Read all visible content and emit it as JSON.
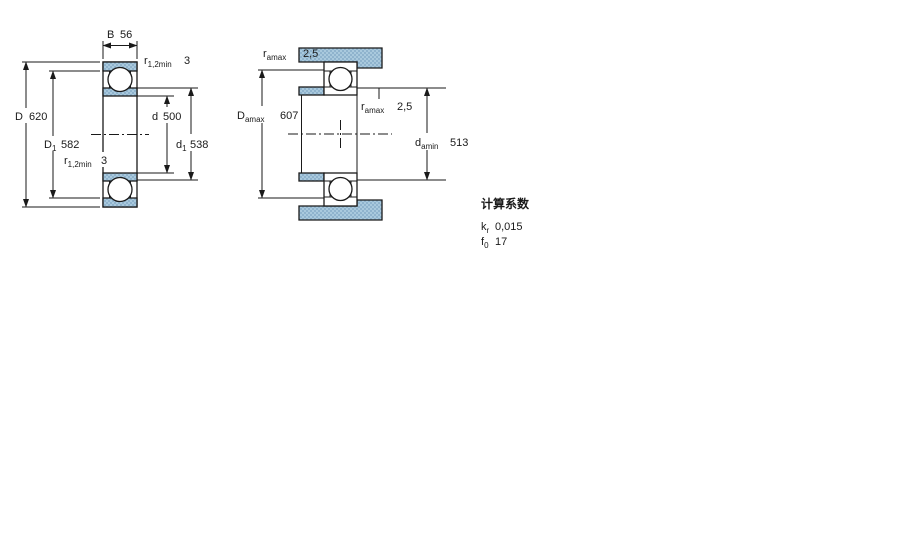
{
  "drawing": {
    "left": {
      "B": {
        "sym": "B",
        "value": "56"
      },
      "r_top": {
        "sym": "r",
        "sub": "1,2min",
        "value": "3"
      },
      "D": {
        "sym": "D",
        "value": "620"
      },
      "D1": {
        "sym": "D",
        "sub": "1",
        "value": "582"
      },
      "r_bottom": {
        "sym": "r",
        "sub": "1,2min",
        "value": "3"
      },
      "d": {
        "sym": "d",
        "value": "500"
      },
      "d1": {
        "sym": "d",
        "sub": "1",
        "value": "538"
      }
    },
    "right": {
      "ra_top": {
        "sym": "r",
        "sub": "amax",
        "value": "2,5"
      },
      "Da": {
        "sym": "D",
        "sub": "amax",
        "value": "607"
      },
      "ra_mid": {
        "sym": "r",
        "sub": "amax",
        "value": "2,5"
      },
      "da": {
        "sym": "d",
        "sub": "amin",
        "value": "513"
      }
    },
    "factors": {
      "title": "计算系数",
      "rows": [
        {
          "sym": "k",
          "sub": "r",
          "value": "0,015"
        },
        {
          "sym": "f",
          "sub": "0",
          "value": "17"
        }
      ]
    },
    "colors": {
      "steel": "#a9c9dd",
      "steel_dot": "#8fb3cd",
      "line": "#1a1a1a",
      "background": "#ffffff"
    }
  }
}
